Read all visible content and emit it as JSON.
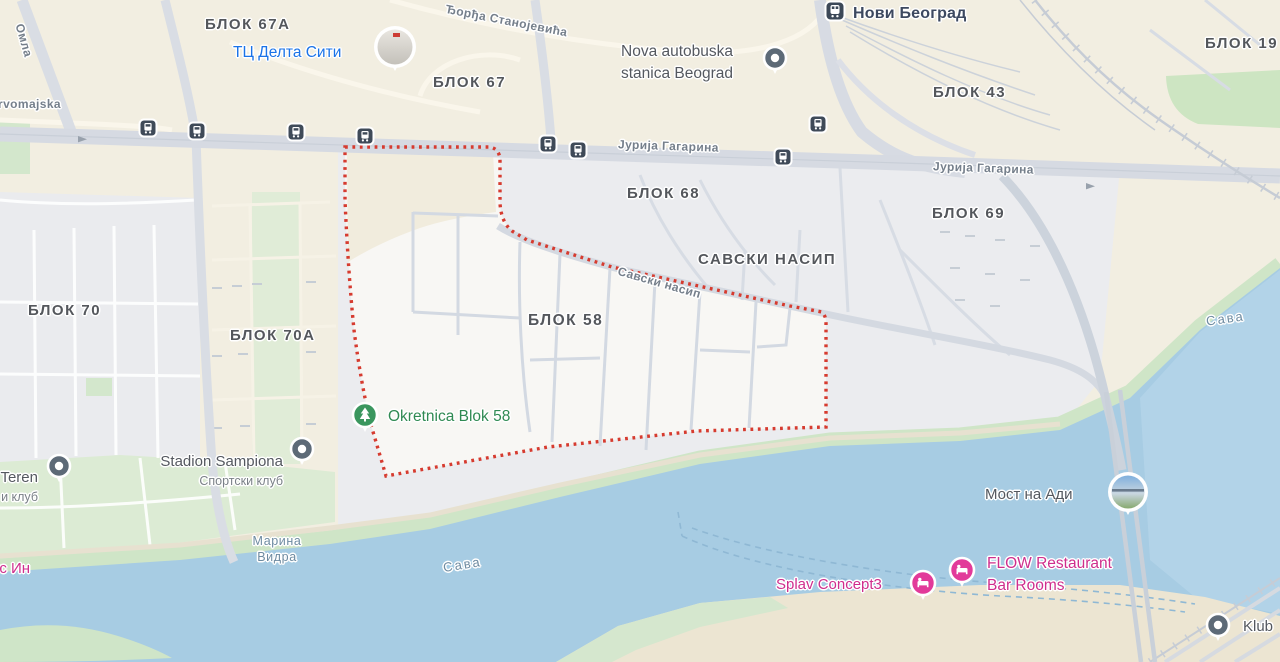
{
  "map_title": "Блок 58 map, Novi Beograd",
  "region": {
    "name": "БЛОК 58",
    "boundary_style": "red-dotted",
    "boundary_color": "#d63b2f"
  },
  "colors": {
    "land": "#f2eee1",
    "urban": "#ebecef",
    "selected_region": "#f8f7f4",
    "water": "#a7cce3",
    "park": "#cfe5c7",
    "road": "#d6dae2",
    "boundary_red": "#d63b2f",
    "poi_blue": "#1a73e8",
    "poi_green": "#2f8a53",
    "poi_pink": "#cf2e8d",
    "poi_gray": "#54585f",
    "transit_icon_bg": "#3f4a58",
    "pin_gray": "#5d6a77",
    "pin_pink": "#e23a9a",
    "pin_green": "#3a965e"
  },
  "areas": [
    {
      "name": "БЛОК 67А"
    },
    {
      "name": "БЛОК 67"
    },
    {
      "name": "БЛОК 43"
    },
    {
      "name": "БЛОК 19"
    },
    {
      "name": "БЛОК 68"
    },
    {
      "name": "БЛОК 69"
    },
    {
      "name": "САВСКИ НАСИП"
    },
    {
      "name": "БЛОК 58"
    },
    {
      "name": "БЛОК 70"
    },
    {
      "name": "БЛОК 70А"
    }
  ],
  "streets": [
    {
      "name": "Ђорђа Станојевића"
    },
    {
      "name": "Јурија Гагарина"
    },
    {
      "name": "Јурија Гагарина"
    },
    {
      "name": "Савски насип"
    },
    {
      "name": "rvomajska"
    },
    {
      "name": "Омла"
    }
  ],
  "waters": [
    {
      "name": "Марина\nВидра"
    },
    {
      "name": "Сава"
    },
    {
      "name": "Сава"
    }
  ],
  "pois": [
    {
      "name": "ТЦ Делта Сити",
      "type": "shopping-mall",
      "marker": "photo-circle"
    },
    {
      "name": "Нови Београд",
      "type": "train-station",
      "marker": "train-station-icon"
    },
    {
      "name": "Nova autobuska\nstanica Beograd",
      "type": "bus-station",
      "marker": "gray-pin"
    },
    {
      "name": "Okretnica Blok 58",
      "type": "park-turnaround",
      "marker": "green-tree-pin"
    },
    {
      "name": "Stadion Sampiona",
      "subtitle": "Спортски клуб",
      "type": "sports-club",
      "marker": "gray-pin"
    },
    {
      "name": "Teren",
      "subtitle": "и клуб",
      "type": "sports-club",
      "marker": "gray-pin"
    },
    {
      "name": "ус Ин",
      "type": "restaurant",
      "marker": "none"
    },
    {
      "name": "Мост на Ади",
      "type": "bridge",
      "marker": "photo-circle"
    },
    {
      "name": "Splav Concept3",
      "type": "lodging",
      "marker": "pink-bed-pin"
    },
    {
      "name": "FLOW Restaurant\nBar Rooms",
      "type": "lodging",
      "marker": "pink-bed-pin"
    },
    {
      "name": "Klub",
      "type": "club",
      "marker": "gray-pin"
    }
  ],
  "transit_stops": {
    "bus_stop_count": 8,
    "icon": "bus-stop-icon",
    "train_icon": "train-station-icon"
  }
}
